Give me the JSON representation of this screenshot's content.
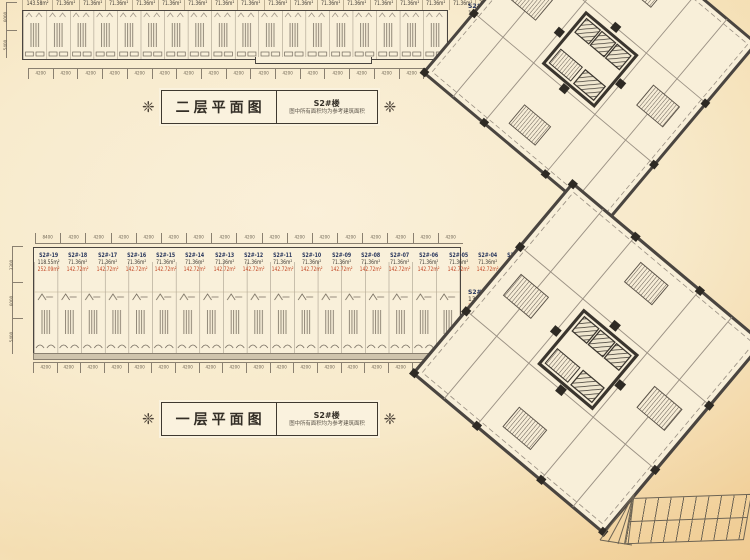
{
  "colors": {
    "wall": "#4a4540",
    "thin_line": "#9b9184",
    "unit_id_text": "#27355c",
    "area_text": "#3f3a34",
    "highlight_area_text": "#c34a28",
    "background_center": "#f9f0da",
    "background_edge": "#eec287"
  },
  "ornament_glyph": "❈",
  "floor2": {
    "plaque": {
      "title": "二层平面图",
      "building": "S2#楼",
      "note": "图中所有面积均为参考建筑面积"
    },
    "strip_areas": [
      "143.58m²",
      "71.36m²",
      "71.36m²",
      "71.36m²",
      "71.36m²",
      "71.36m²",
      "71.36m²",
      "71.36m²",
      "71.36m²",
      "71.36m²",
      "71.36m²",
      "71.36m²",
      "71.36m²",
      "71.36m²",
      "71.36m²",
      "71.36m²",
      "71.36m²",
      "71.36m²"
    ],
    "dims_bottom": [
      "4200",
      "4200",
      "4200",
      "4200",
      "4200",
      "4200",
      "4200",
      "4200",
      "4200",
      "4200",
      "4200",
      "4200",
      "4200",
      "4200",
      "4200",
      "4200",
      "4200"
    ],
    "dims_left": [
      "6000",
      "5400"
    ],
    "tower_label": {
      "unit": "S2#-01",
      "area": "141.97m²"
    }
  },
  "floor1": {
    "plaque": {
      "title": "一层平面图",
      "building": "S2#楼",
      "note": "图中所有面积均为参考建筑面积"
    },
    "units": [
      {
        "id": "S2#-19",
        "area": "118.55m²",
        "area2": "252.09m²"
      },
      {
        "id": "S2#-18",
        "area": "71.36m²",
        "area2": "142.72m²"
      },
      {
        "id": "S2#-17",
        "area": "71.36m²",
        "area2": "142.72m²"
      },
      {
        "id": "S2#-16",
        "area": "71.36m²",
        "area2": "142.72m²"
      },
      {
        "id": "S2#-15",
        "area": "71.36m²",
        "area2": "142.72m²"
      },
      {
        "id": "S2#-14",
        "area": "71.36m²",
        "area2": "142.72m²"
      },
      {
        "id": "S2#-13",
        "area": "71.36m²",
        "area2": "142.72m²"
      },
      {
        "id": "S2#-12",
        "area": "71.36m²",
        "area2": "142.72m²"
      },
      {
        "id": "S2#-11",
        "area": "71.36m²",
        "area2": "142.72m²"
      },
      {
        "id": "S2#-10",
        "area": "71.36m²",
        "area2": "142.72m²"
      },
      {
        "id": "S2#-09",
        "area": "71.36m²",
        "area2": "142.72m²"
      },
      {
        "id": "S2#-08",
        "area": "71.36m²",
        "area2": "142.72m²"
      },
      {
        "id": "S2#-07",
        "area": "71.36m²",
        "area2": "142.72m²"
      },
      {
        "id": "S2#-06",
        "area": "71.36m²",
        "area2": "142.72m²"
      },
      {
        "id": "S2#-05",
        "area": "71.36m²",
        "area2": "142.72m²"
      },
      {
        "id": "S2#-04",
        "area": "71.36m²",
        "area2": "142.72m²"
      },
      {
        "id": "S2#-03",
        "area": "71.36m²",
        "area2": "142.72m²"
      },
      {
        "id": "S2#-02",
        "area": "71.36m²",
        "area2": "142.72m²"
      }
    ],
    "dims_top": [
      "8400",
      "4200",
      "4200",
      "4200",
      "4200",
      "4200",
      "4200",
      "4200",
      "4200",
      "4200",
      "4200",
      "4200",
      "4200",
      "4200",
      "4200",
      "4200",
      "4200"
    ],
    "dims_bottom": [
      "4200",
      "4200",
      "4200",
      "4200",
      "4200",
      "4200",
      "4200",
      "4200",
      "4200",
      "4200",
      "4200",
      "4200",
      "4200",
      "4200",
      "4200",
      "4200",
      "4200",
      "4200"
    ],
    "dims_left": [
      "3300",
      "6000",
      "5400"
    ],
    "tower_label": {
      "unit": "S2#-01",
      "area": "130.81m²",
      "area2": "281.78m²"
    }
  }
}
